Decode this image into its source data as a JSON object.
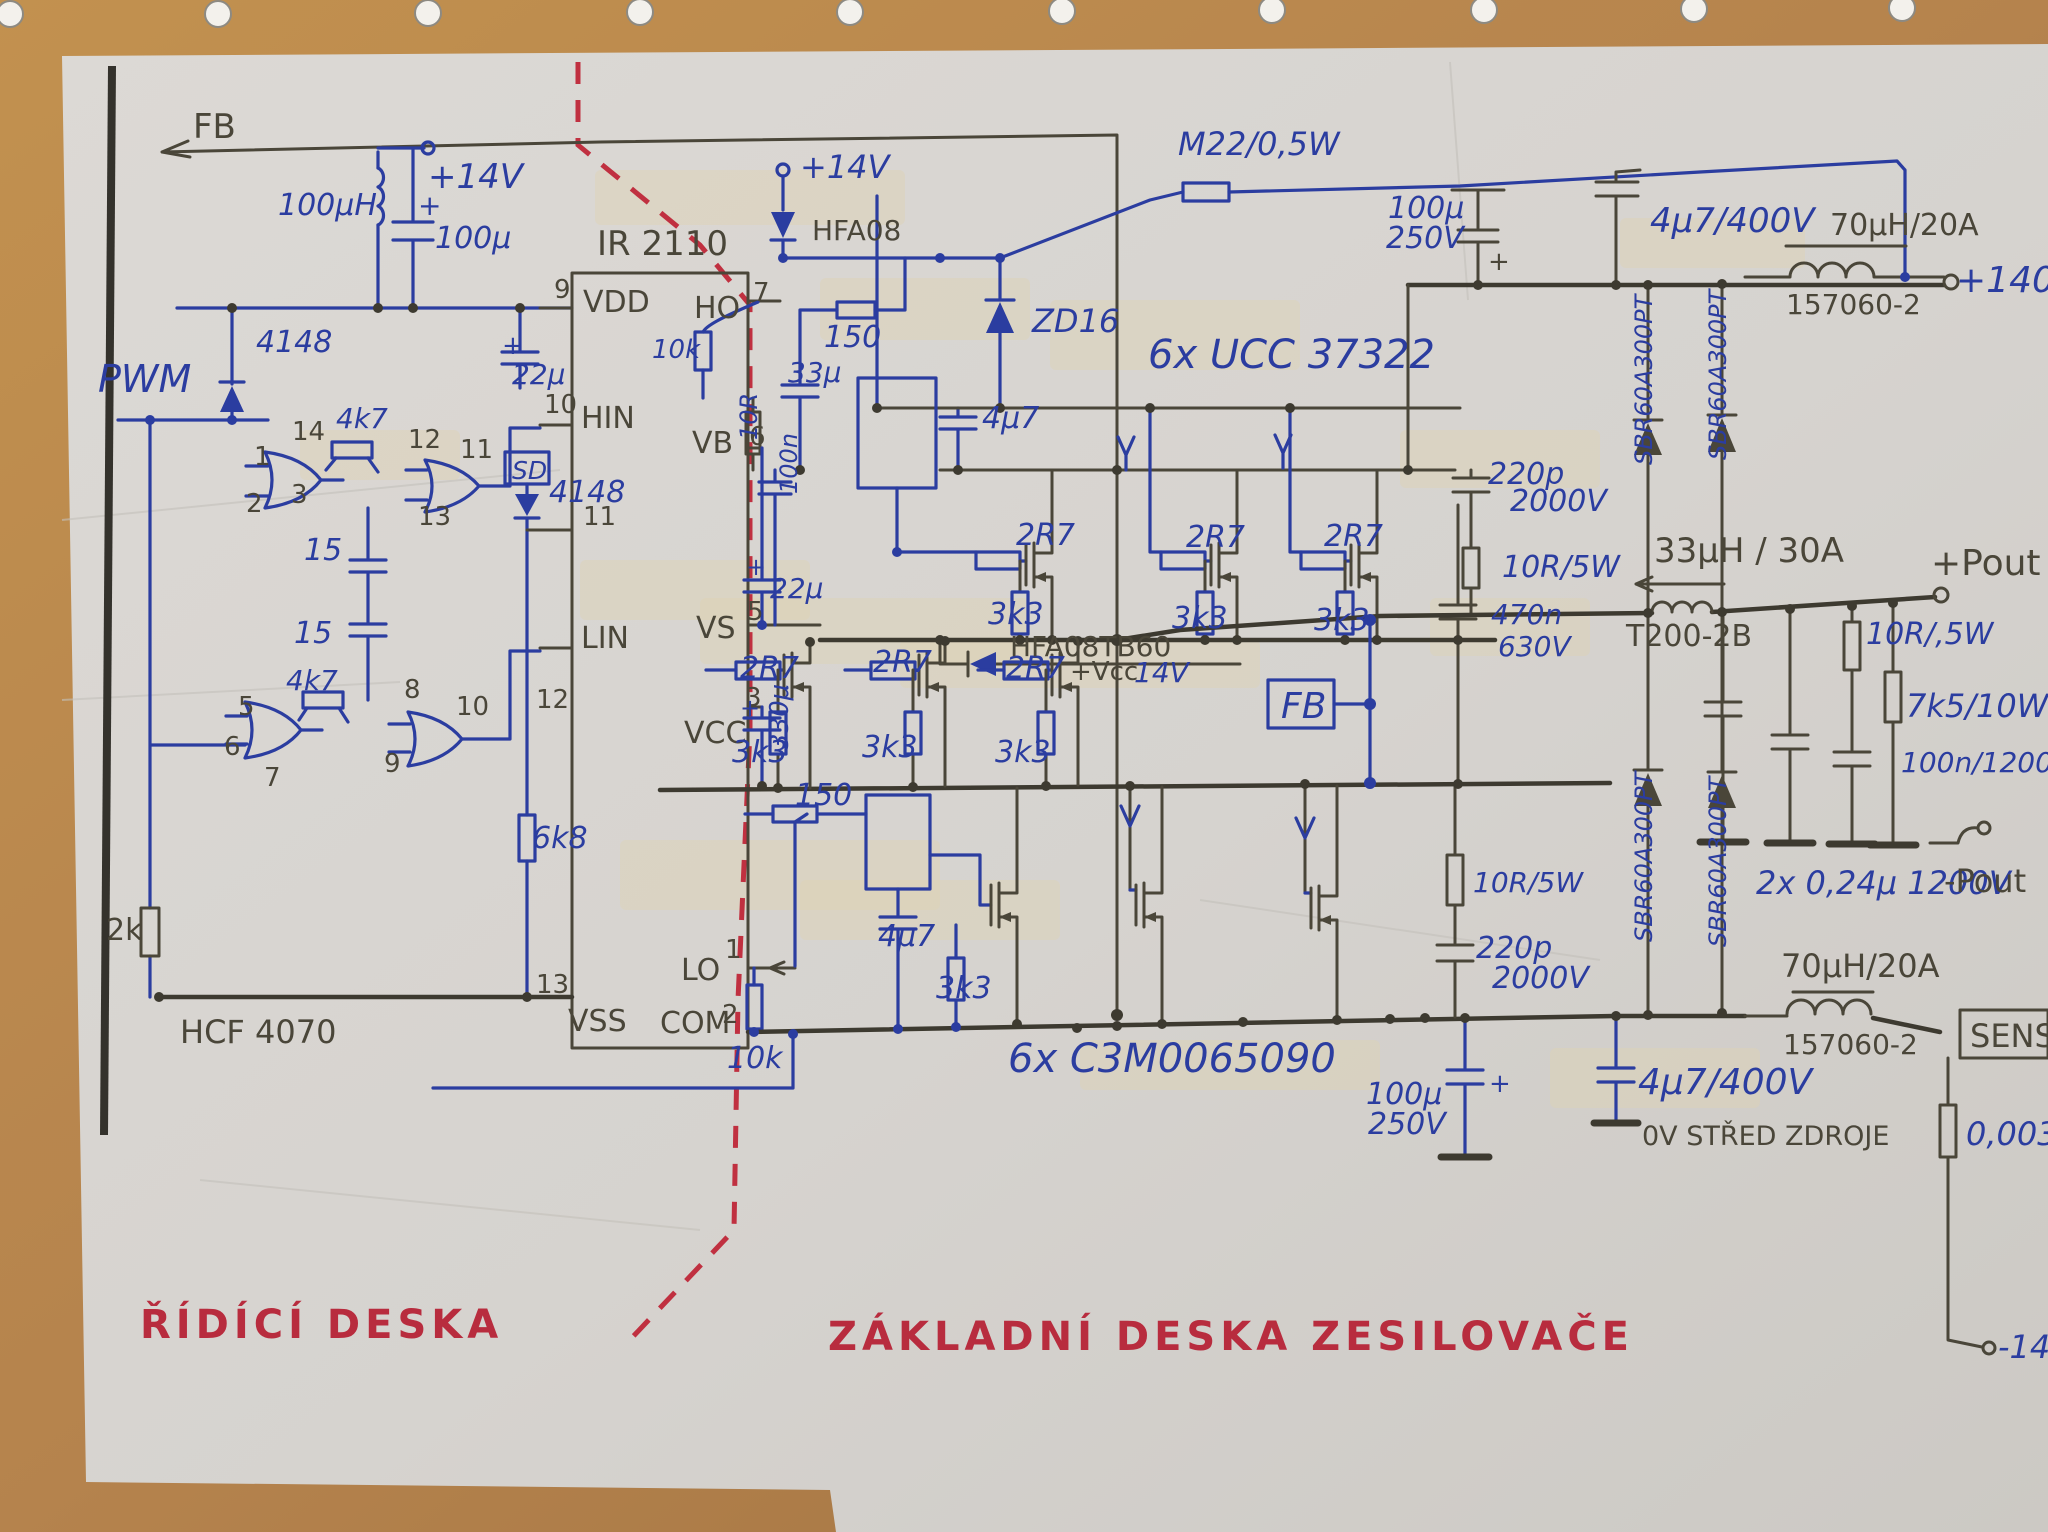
{
  "colors": {
    "ink_blue": "#2b3da0",
    "pencil": "#4a4639",
    "red_marker": "#b82c3e",
    "paper": "#d8d5d1",
    "wood_desk": "#b5834d",
    "margin_line": "#34322c",
    "divider_dashed": "#c03040"
  },
  "board_titles": {
    "control_board": "ŘÍDÍCÍ DESKA",
    "power_board": "ZÁKLADNÍ DESKA ZESILOVAČE"
  },
  "ics": {
    "driver_ic": "IR 2110",
    "logic_ic": "HCF 4070",
    "gate_drivers": "6x UCC 37322",
    "mosfets": "6x C3M0065090"
  },
  "labels": [
    {
      "n": "fb-top-label",
      "t": "FB",
      "x": 193,
      "y": 138,
      "c": "p",
      "s": 34
    },
    {
      "n": "inductor-100uh-label",
      "t": "100μH",
      "x": 278,
      "y": 215,
      "c": "b",
      "s": 30
    },
    {
      "n": "plus-14v-left-label",
      "t": "+14V",
      "x": 428,
      "y": 188,
      "c": "b",
      "s": 34
    },
    {
      "n": "plus-sign-100u-left",
      "t": "+",
      "x": 418,
      "y": 215,
      "c": "b",
      "s": 28
    },
    {
      "n": "cap-100u-left-label",
      "t": "100μ",
      "x": 435,
      "y": 248,
      "c": "b",
      "s": 30
    },
    {
      "n": "ic-ir2110-label",
      "t": "IR 2110",
      "x": 597,
      "y": 255,
      "c": "p",
      "s": 34
    },
    {
      "n": "plus-sign-22u-vdd",
      "t": "+",
      "x": 502,
      "y": 354,
      "c": "b",
      "s": 26
    },
    {
      "n": "cap-22u-vdd-label",
      "t": "22μ",
      "x": 512,
      "y": 384,
      "c": "b",
      "s": 28
    },
    {
      "n": "diode-4148-pwm-label",
      "t": "4148",
      "x": 256,
      "y": 352,
      "c": "b",
      "s": 30
    },
    {
      "n": "pwm-label",
      "t": "PWM",
      "x": 98,
      "y": 392,
      "c": "b",
      "s": 38
    },
    {
      "n": "res-4k7-upper-label",
      "t": "4k7",
      "x": 336,
      "y": 428,
      "c": "b",
      "s": 28
    },
    {
      "n": "res-4k7-lower-label",
      "t": "4k7",
      "x": 286,
      "y": 690,
      "c": "b",
      "s": 28
    },
    {
      "n": "cap-15-upper-label",
      "t": "15",
      "x": 304,
      "y": 560,
      "c": "b",
      "s": 30
    },
    {
      "n": "cap-15-lower-label",
      "t": "15",
      "x": 294,
      "y": 643,
      "c": "b",
      "s": 30
    },
    {
      "n": "sd-box-label",
      "t": "SD",
      "x": 512,
      "y": 479,
      "c": "b",
      "s": 25
    },
    {
      "n": "diode-4148-sd-label",
      "t": "4148",
      "x": 549,
      "y": 502,
      "c": "b",
      "s": 30
    },
    {
      "n": "res-6k8-label",
      "t": "6k8",
      "x": 532,
      "y": 848,
      "c": "b",
      "s": 30
    },
    {
      "n": "res-2k-label",
      "t": "2k",
      "x": 106,
      "y": 940,
      "c": "p",
      "s": 30
    },
    {
      "n": "ic-hcf4070-label",
      "t": "HCF 4070",
      "x": 180,
      "y": 1043,
      "c": "p",
      "s": 32
    },
    {
      "n": "res-10k-bottom-label",
      "t": "10k",
      "x": 727,
      "y": 1068,
      "c": "b",
      "s": 30
    },
    {
      "n": "gate1-pin1",
      "t": "1",
      "x": 254,
      "y": 465,
      "c": "p",
      "s": 26
    },
    {
      "n": "gate1-pin2",
      "t": "2",
      "x": 246,
      "y": 512,
      "c": "p",
      "s": 26
    },
    {
      "n": "gate1-pin3",
      "t": "3",
      "x": 291,
      "y": 503,
      "c": "p",
      "s": 26
    },
    {
      "n": "gate1-pin14",
      "t": "14",
      "x": 292,
      "y": 440,
      "c": "p",
      "s": 26
    },
    {
      "n": "gate2-pin12",
      "t": "12",
      "x": 408,
      "y": 448,
      "c": "p",
      "s": 26
    },
    {
      "n": "gate2-pin11",
      "t": "11",
      "x": 460,
      "y": 458,
      "c": "p",
      "s": 26
    },
    {
      "n": "gate2-pin13",
      "t": "13",
      "x": 418,
      "y": 525,
      "c": "p",
      "s": 26
    },
    {
      "n": "gate3-pin5",
      "t": "5",
      "x": 238,
      "y": 715,
      "c": "p",
      "s": 26
    },
    {
      "n": "gate3-pin6",
      "t": "6",
      "x": 224,
      "y": 755,
      "c": "p",
      "s": 26
    },
    {
      "n": "gate3-pin7",
      "t": "7",
      "x": 264,
      "y": 786,
      "c": "p",
      "s": 26
    },
    {
      "n": "gate4-pin8",
      "t": "8",
      "x": 404,
      "y": 698,
      "c": "p",
      "s": 26
    },
    {
      "n": "gate4-pin9",
      "t": "9",
      "x": 384,
      "y": 772,
      "c": "p",
      "s": 26
    },
    {
      "n": "gate4-pin10",
      "t": "10",
      "x": 456,
      "y": 715,
      "c": "p",
      "s": 26
    },
    {
      "n": "ic-pin9",
      "t": "9",
      "x": 554,
      "y": 298,
      "c": "p",
      "s": 26
    },
    {
      "n": "ic-pin-vdd",
      "t": "VDD",
      "x": 583,
      "y": 312,
      "c": "p",
      "s": 30
    },
    {
      "n": "ic-pin10",
      "t": "10",
      "x": 544,
      "y": 413,
      "c": "p",
      "s": 26
    },
    {
      "n": "ic-pin-hin",
      "t": "HIN",
      "x": 581,
      "y": 428,
      "c": "p",
      "s": 30
    },
    {
      "n": "ic-pin11",
      "t": "11",
      "x": 583,
      "y": 525,
      "c": "p",
      "s": 26
    },
    {
      "n": "ic-pin12",
      "t": "12",
      "x": 536,
      "y": 708,
      "c": "p",
      "s": 26
    },
    {
      "n": "ic-pin-lin",
      "t": "LIN",
      "x": 581,
      "y": 648,
      "c": "p",
      "s": 30
    },
    {
      "n": "ic-pin13",
      "t": "13",
      "x": 536,
      "y": 993,
      "c": "p",
      "s": 26
    },
    {
      "n": "ic-pin-vss",
      "t": "VSS",
      "x": 568,
      "y": 1031,
      "c": "p",
      "s": 30
    },
    {
      "n": "ic-pin7",
      "t": "7",
      "x": 753,
      "y": 301,
      "c": "p",
      "s": 26
    },
    {
      "n": "ic-pin-ho",
      "t": "HO",
      "x": 694,
      "y": 318,
      "c": "p",
      "s": 30
    },
    {
      "n": "ic-pin6",
      "t": "6",
      "x": 749,
      "y": 445,
      "c": "p",
      "s": 26
    },
    {
      "n": "ic-pin-vb",
      "t": "VB",
      "x": 692,
      "y": 453,
      "c": "p",
      "s": 30
    },
    {
      "n": "ic-pin5",
      "t": "5",
      "x": 747,
      "y": 620,
      "c": "p",
      "s": 26
    },
    {
      "n": "ic-pin-vs",
      "t": "VS",
      "x": 696,
      "y": 638,
      "c": "p",
      "s": 30
    },
    {
      "n": "ic-pin3",
      "t": "3",
      "x": 745,
      "y": 706,
      "c": "p",
      "s": 26
    },
    {
      "n": "ic-pin-vcc",
      "t": "VCC",
      "x": 684,
      "y": 743,
      "c": "p",
      "s": 30
    },
    {
      "n": "ic-pin1",
      "t": "1",
      "x": 725,
      "y": 958,
      "c": "p",
      "s": 26
    },
    {
      "n": "ic-pin-lo",
      "t": "LO",
      "x": 681,
      "y": 980,
      "c": "p",
      "s": 30
    },
    {
      "n": "ic-pin2",
      "t": "2",
      "x": 722,
      "y": 1023,
      "c": "p",
      "s": 26
    },
    {
      "n": "ic-pin-com",
      "t": "COM",
      "x": 660,
      "y": 1033,
      "c": "p",
      "s": 30
    },
    {
      "n": "plus-14v-mid-label",
      "t": "+14V",
      "x": 800,
      "y": 178,
      "c": "b",
      "s": 32
    },
    {
      "n": "diode-hfa08-label",
      "t": "HFA08",
      "x": 812,
      "y": 240,
      "c": "p",
      "s": 28
    },
    {
      "n": "res-10k-ho-label",
      "t": "10k",
      "x": 652,
      "y": 358,
      "c": "b",
      "s": 26
    },
    {
      "n": "res-150-top-label",
      "t": "150",
      "x": 824,
      "y": 347,
      "c": "b",
      "s": 30
    },
    {
      "n": "cap-33u-label",
      "t": "33μ",
      "x": 788,
      "y": 382,
      "c": "b",
      "s": 28
    },
    {
      "n": "res-10r-vert-label",
      "t": "10R",
      "x": 757,
      "y": 440,
      "c": "b",
      "s": 24,
      "r": -90
    },
    {
      "n": "cap-100n-vert-label",
      "t": "100n",
      "x": 797,
      "y": 494,
      "c": "b",
      "s": 24,
      "r": -90
    },
    {
      "n": "zener-zd16-label",
      "t": "ZD16",
      "x": 1032,
      "y": 332,
      "c": "b",
      "s": 32
    },
    {
      "n": "cap-4u7-top-label",
      "t": "4μ7",
      "x": 982,
      "y": 428,
      "c": "b",
      "s": 30
    },
    {
      "n": "ucc37322-label",
      "t": "6x UCC 37322",
      "x": 1148,
      "y": 368,
      "c": "b",
      "s": 40
    },
    {
      "n": "plus-sign-22u-vb",
      "t": "+",
      "x": 746,
      "y": 575,
      "c": "b",
      "s": 24
    },
    {
      "n": "cap-22u-vb-label",
      "t": "22μ",
      "x": 770,
      "y": 598,
      "c": "b",
      "s": 28
    },
    {
      "n": "plus-sign-330u",
      "t": "+",
      "x": 740,
      "y": 716,
      "c": "b",
      "s": 24
    },
    {
      "n": "cap-330u-label",
      "t": "330μ",
      "x": 788,
      "y": 750,
      "c": "b",
      "s": 26,
      "r": -90
    },
    {
      "n": "res-2r7-a1-label",
      "t": "2R7",
      "x": 1016,
      "y": 545,
      "c": "b",
      "s": 30
    },
    {
      "n": "res-2r7-a2-label",
      "t": "2R7",
      "x": 1186,
      "y": 547,
      "c": "b",
      "s": 30
    },
    {
      "n": "res-2r7-a3-label",
      "t": "2R7",
      "x": 1324,
      "y": 546,
      "c": "b",
      "s": 30
    },
    {
      "n": "res-3k3-a1-label",
      "t": "3k3",
      "x": 988,
      "y": 624,
      "c": "b",
      "s": 30
    },
    {
      "n": "res-3k3-a2-label",
      "t": "3k3",
      "x": 1172,
      "y": 628,
      "c": "b",
      "s": 30
    },
    {
      "n": "res-3k3-a3-label",
      "t": "3k3",
      "x": 1314,
      "y": 630,
      "c": "b",
      "s": 30
    },
    {
      "n": "res-2r7-b1-label",
      "t": "2R7",
      "x": 740,
      "y": 678,
      "c": "b",
      "s": 30
    },
    {
      "n": "res-2r7-b2-label",
      "t": "2R7",
      "x": 873,
      "y": 672,
      "c": "b",
      "s": 30
    },
    {
      "n": "res-2r7-b3-label",
      "t": "2R7",
      "x": 1006,
      "y": 678,
      "c": "b",
      "s": 30
    },
    {
      "n": "res-3k3-b1-label",
      "t": "3k3",
      "x": 732,
      "y": 762,
      "c": "b",
      "s": 30
    },
    {
      "n": "res-3k3-b2-label",
      "t": "3k3",
      "x": 862,
      "y": 757,
      "c": "b",
      "s": 30
    },
    {
      "n": "res-3k3-b3-label",
      "t": "3k3",
      "x": 995,
      "y": 762,
      "c": "b",
      "s": 30
    },
    {
      "n": "diode-hfa08tb60-label",
      "t": "HFA08TB60",
      "x": 1010,
      "y": 656,
      "c": "p",
      "s": 28
    },
    {
      "n": "vcc-plus-label",
      "t": "+Vcc",
      "x": 1070,
      "y": 680,
      "c": "p",
      "s": 26
    },
    {
      "n": "vcc-14v-label",
      "t": "14V",
      "x": 1134,
      "y": 682,
      "c": "b",
      "s": 28
    },
    {
      "n": "fb-box-label",
      "t": "FB",
      "x": 1281,
      "y": 718,
      "c": "b",
      "s": 36
    },
    {
      "n": "res-150-low-label",
      "t": "150",
      "x": 795,
      "y": 805,
      "c": "b",
      "s": 30
    },
    {
      "n": "cap-4u7-low-label",
      "t": "4μ7",
      "x": 878,
      "y": 946,
      "c": "b",
      "s": 30
    },
    {
      "n": "res-3k3-low-label",
      "t": "3k3",
      "x": 936,
      "y": 998,
      "c": "b",
      "s": 30
    },
    {
      "n": "c3m-label",
      "t": "6x C3M0065090",
      "x": 1008,
      "y": 1072,
      "c": "b",
      "s": 40
    },
    {
      "n": "res-m22-label",
      "t": "M22/0,5W",
      "x": 1178,
      "y": 155,
      "c": "b",
      "s": 32
    },
    {
      "n": "cap-100u250-top-label1",
      "t": "100μ",
      "x": 1388,
      "y": 218,
      "c": "b",
      "s": 30
    },
    {
      "n": "cap-100u250-top-label2",
      "t": "250V",
      "x": 1386,
      "y": 248,
      "c": "b",
      "s": 30
    },
    {
      "n": "plus-sign-100u-top",
      "t": "+",
      "x": 1488,
      "y": 270,
      "c": "p",
      "s": 26
    },
    {
      "n": "cap-4u7-400-top-label",
      "t": "4μ7/400V",
      "x": 1650,
      "y": 232,
      "c": "b",
      "s": 34
    },
    {
      "n": "inductor-70uh-top-label",
      "t": "70μH/20A",
      "x": 1830,
      "y": 235,
      "c": "p",
      "s": 30
    },
    {
      "n": "inductor-157060-top-label",
      "t": "157060-2",
      "x": 1786,
      "y": 314,
      "c": "p",
      "s": 28
    },
    {
      "n": "plus-140v-label",
      "t": "+140V",
      "x": 1956,
      "y": 292,
      "c": "b",
      "s": 36
    },
    {
      "n": "sbr-diode-label-1",
      "t": "SBR60A300PT",
      "x": 1652,
      "y": 465,
      "c": "b",
      "s": 24,
      "r": -90
    },
    {
      "n": "sbr-diode-label-2",
      "t": "SBR60A300PT",
      "x": 1726,
      "y": 460,
      "c": "b",
      "s": 24,
      "r": -90
    },
    {
      "n": "sbr-diode-label-3",
      "t": "SBR60A300PT",
      "x": 1652,
      "y": 942,
      "c": "b",
      "s": 24,
      "r": -90
    },
    {
      "n": "sbr-diode-label-4",
      "t": "SBR60A300PT",
      "x": 1726,
      "y": 947,
      "c": "b",
      "s": 24,
      "r": -90
    },
    {
      "n": "cap-220p-top-label1",
      "t": "220p",
      "x": 1488,
      "y": 484,
      "c": "b",
      "s": 30
    },
    {
      "n": "cap-220p-top-label2",
      "t": "2000V",
      "x": 1510,
      "y": 511,
      "c": "b",
      "s": 30
    },
    {
      "n": "res-10r5w-top-label",
      "t": "10R/5W",
      "x": 1502,
      "y": 577,
      "c": "b",
      "s": 30
    },
    {
      "n": "inductor-33uh-label",
      "t": "33μH / 30A",
      "x": 1654,
      "y": 562,
      "c": "p",
      "s": 34
    },
    {
      "n": "inductor-t200-label",
      "t": "T200-2B",
      "x": 1626,
      "y": 646,
      "c": "p",
      "s": 30
    },
    {
      "n": "cap-470n-label1",
      "t": "470n",
      "x": 1491,
      "y": 624,
      "c": "b",
      "s": 28
    },
    {
      "n": "cap-470n-label2",
      "t": "630V",
      "x": 1498,
      "y": 656,
      "c": "b",
      "s": 28
    },
    {
      "n": "res-10r5w-low-label",
      "t": "10R/5W",
      "x": 1473,
      "y": 892,
      "c": "b",
      "s": 28
    },
    {
      "n": "cap-220p-low-label1",
      "t": "220p",
      "x": 1476,
      "y": 958,
      "c": "b",
      "s": 30
    },
    {
      "n": "cap-220p-low-label2",
      "t": "2000V",
      "x": 1492,
      "y": 988,
      "c": "b",
      "s": 30
    },
    {
      "n": "pout-plus-label",
      "t": "+Pout",
      "x": 1931,
      "y": 575,
      "c": "p",
      "s": 36
    },
    {
      "n": "res-10r-05w-label",
      "t": "10R/,5W",
      "x": 1866,
      "y": 644,
      "c": "b",
      "s": 30
    },
    {
      "n": "res-7k5-label",
      "t": "7k5/10W",
      "x": 1906,
      "y": 717,
      "c": "b",
      "s": 32
    },
    {
      "n": "cap-100n1200-label",
      "t": "100n/1200V",
      "x": 1901,
      "y": 772,
      "c": "b",
      "s": 28
    },
    {
      "n": "cap-024u-label",
      "t": "2x 0,24μ 1200V",
      "x": 1756,
      "y": 894,
      "c": "b",
      "s": 32
    },
    {
      "n": "pout-minus-label",
      "t": "-Pout",
      "x": 1944,
      "y": 892,
      "c": "p",
      "s": 32
    },
    {
      "n": "inductor-70uh-bot-label",
      "t": "70μH/20A",
      "x": 1781,
      "y": 977,
      "c": "p",
      "s": 32
    },
    {
      "n": "inductor-157060-bot-label",
      "t": "157060-2",
      "x": 1783,
      "y": 1054,
      "c": "p",
      "s": 28
    },
    {
      "n": "sens-box-label",
      "t": "SENS",
      "x": 1970,
      "y": 1047,
      "c": "p",
      "s": 32
    },
    {
      "n": "res-0003-label",
      "t": "0,003",
      "x": 1966,
      "y": 1145,
      "c": "b",
      "s": 32
    },
    {
      "n": "cap-4u7-400-bot-label",
      "t": "4μ7/400V",
      "x": 1638,
      "y": 1094,
      "c": "b",
      "s": 36
    },
    {
      "n": "ov-stred-label",
      "t": "0V STŘED ZDROJE",
      "x": 1642,
      "y": 1145,
      "c": "p",
      "s": 27
    },
    {
      "n": "cap-100u250-bot-label1",
      "t": "100μ",
      "x": 1366,
      "y": 1104,
      "c": "b",
      "s": 30
    },
    {
      "n": "cap-100u250-bot-label2",
      "t": "250V",
      "x": 1368,
      "y": 1134,
      "c": "b",
      "s": 30
    },
    {
      "n": "plus-sign-100u-bot",
      "t": "+",
      "x": 1489,
      "y": 1092,
      "c": "b",
      "s": 26
    },
    {
      "n": "minus-14-label",
      "t": "-14",
      "x": 1998,
      "y": 1358,
      "c": "b",
      "s": 32
    },
    {
      "n": "control-board-title",
      "t": "ŘÍDÍCÍ DESKA",
      "x": 140,
      "y": 1338,
      "c": "r",
      "s": 40
    },
    {
      "n": "power-board-title",
      "t": "ZÁKLADNÍ DESKA ZESILOVAČE",
      "x": 828,
      "y": 1350,
      "c": "r",
      "s": 40
    }
  ]
}
